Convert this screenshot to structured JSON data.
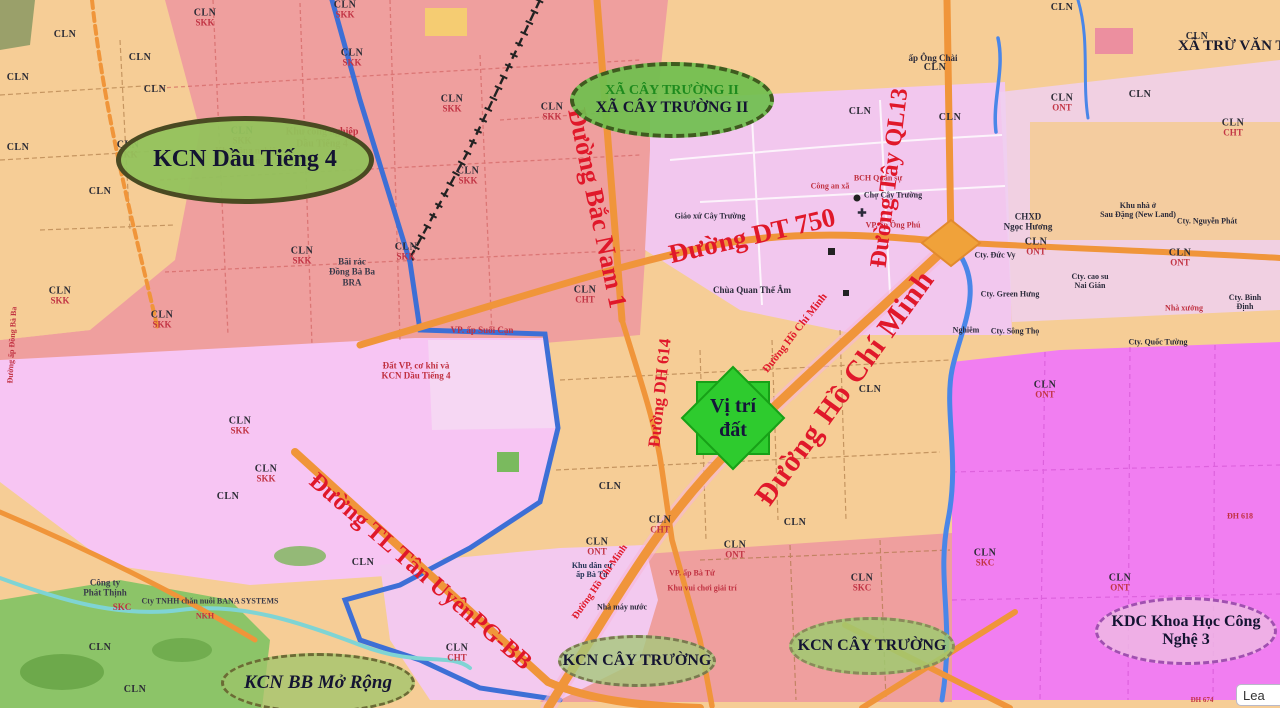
{
  "map": {
    "corner_label": "XÃ TRỪ VĂN THỐ",
    "attribution_partial": "Lea"
  },
  "site_marker": {
    "line1": "Vị trí",
    "line2": "đất"
  },
  "badges": {
    "kcn_dau_tieng_4": {
      "label": "KCN Dầu Tiếng 4"
    },
    "xa_cay_truong_ii": {
      "line1": "XÃ CÂY TRƯỜNG II",
      "line2": "XÃ CÂY TRƯỜNG II"
    },
    "kcn_bb_mo_rong": {
      "label": "KCN BB Mở Rộng"
    },
    "kcn_cay_truong_1": {
      "label": "KCN CÂY TRƯỜNG"
    },
    "kcn_cay_truong_2": {
      "label": "KCN CÂY TRƯỜNG"
    },
    "kdc_khoa_hoc": {
      "line1": "KDC Khoa Học Công",
      "line2": "Nghệ 3"
    }
  },
  "road_labels": {
    "bac_nam_1": "Đường Bắc Nam 1",
    "dt_750": "Đường DT 750",
    "dh_614": "Đường DH 614",
    "ho_chi_minh": "Đường Hồ Chí Minh",
    "ho_chi_minh_small": "Đường Hồ Chí Minh",
    "ho_chi_minh_small2": "Đường Hồ Chí Minh",
    "tay_ql13": "Đường Tây QL13",
    "tl_tan_uyen": "Đường TL Tân UyênPG-BB"
  },
  "poi_labels": [
    {
      "t": "Khu công nghiệp\nDầu Tiếng 4",
      "x": 322,
      "y": 138,
      "c": "#c03040",
      "s": 10
    },
    {
      "t": "Khu công nghiệp\nDầu Tiếng 4",
      "x": 248,
      "y": 156,
      "c": "#c03040",
      "s": 9
    },
    {
      "t": "Bãi rác\nĐồng Bà Ba\nBRA",
      "x": 352,
      "y": 272,
      "c": "#3a3a4a",
      "s": 9
    },
    {
      "t": "Đất VP, cơ khí và\nKCN Dầu Tiếng 4",
      "x": 416,
      "y": 371,
      "c": "#c03040",
      "s": 9
    },
    {
      "t": "VP. ấp Suối Cạn",
      "x": 482,
      "y": 330,
      "c": "#c03040",
      "s": 9
    },
    {
      "t": "Đường ấp Đồng Bà Ba",
      "x": 12,
      "y": 345,
      "c": "#c03040",
      "s": 8,
      "r": -87
    },
    {
      "t": "Công ty\nPhát Thịnh",
      "x": 105,
      "y": 588,
      "c": "#3a3a4a",
      "s": 9
    },
    {
      "t": "Cty TNHH chăn nuôi BANA SYSTEMS",
      "x": 210,
      "y": 601,
      "c": "#3a3a4a",
      "s": 8
    },
    {
      "t": "NKH",
      "x": 205,
      "y": 616,
      "c": "#c03040",
      "s": 8
    },
    {
      "t": "SKC",
      "x": 122,
      "y": 607,
      "c": "#c03040",
      "s": 9
    },
    {
      "t": "ấp Ông Chài",
      "x": 933,
      "y": 58,
      "c": "#2a2a3a",
      "s": 9
    },
    {
      "t": "Công an xã",
      "x": 830,
      "y": 186,
      "c": "#c03040",
      "s": 8
    },
    {
      "t": "BCH Quân sự",
      "x": 878,
      "y": 178,
      "c": "#c03040",
      "s": 8
    },
    {
      "t": "Chợ Cây Trường",
      "x": 893,
      "y": 195,
      "c": "#2a2a3a",
      "s": 8
    },
    {
      "t": "✚",
      "x": 862,
      "y": 214,
      "c": "#2a2a3a",
      "s": 11
    },
    {
      "t": "VP. ấp Ông Phú",
      "x": 893,
      "y": 225,
      "c": "#c03040",
      "s": 8
    },
    {
      "t": "Giáo xứ Cây Trường",
      "x": 710,
      "y": 216,
      "c": "#2a2a3a",
      "s": 8
    },
    {
      "t": "Chùa Quan Thế Âm",
      "x": 752,
      "y": 290,
      "c": "#2a2a3a",
      "s": 9
    },
    {
      "t": "CHXD\nNgọc Hương",
      "x": 1028,
      "y": 222,
      "c": "#2a2a3a",
      "s": 9
    },
    {
      "t": "Cty. Đức Vy",
      "x": 995,
      "y": 255,
      "c": "#2a2a3a",
      "s": 8
    },
    {
      "t": "Khu nhà ở\nSau Đặng (New Land)",
      "x": 1138,
      "y": 210,
      "c": "#2a2a3a",
      "s": 8
    },
    {
      "t": "Cty. Nguyễn Phát",
      "x": 1207,
      "y": 221,
      "c": "#2a2a3a",
      "s": 8
    },
    {
      "t": "Cty. cao su\nNai Gián",
      "x": 1090,
      "y": 281,
      "c": "#2a2a3a",
      "s": 8
    },
    {
      "t": "Cty. Green Hưng",
      "x": 1010,
      "y": 294,
      "c": "#2a2a3a",
      "s": 8
    },
    {
      "t": "Cty. Bình Định",
      "x": 1245,
      "y": 302,
      "c": "#2a2a3a",
      "s": 8
    },
    {
      "t": "Nhà xưởng",
      "x": 1184,
      "y": 308,
      "c": "#c03040",
      "s": 8
    },
    {
      "t": "Cty. Quốc Tường",
      "x": 1158,
      "y": 342,
      "c": "#2a2a3a",
      "s": 8
    },
    {
      "t": "Cty. Sông Thọ",
      "x": 1015,
      "y": 331,
      "c": "#2a2a3a",
      "s": 8
    },
    {
      "t": "Nghiêm",
      "x": 966,
      "y": 330,
      "c": "#2a2a3a",
      "s": 8
    },
    {
      "t": "Khu dân cư\nấp Bà Tứ",
      "x": 592,
      "y": 570,
      "c": "#223355",
      "s": 8
    },
    {
      "t": "VP. ấp Bà Tứ",
      "x": 692,
      "y": 573,
      "c": "#c03040",
      "s": 8
    },
    {
      "t": "Khu vui chơi giải trí",
      "x": 702,
      "y": 588,
      "c": "#c03040",
      "s": 8
    },
    {
      "t": "Nhà máy nước",
      "x": 622,
      "y": 607,
      "c": "#2a2a3a",
      "s": 8
    },
    {
      "t": "ĐH 618",
      "x": 1240,
      "y": 516,
      "c": "#c03040",
      "s": 8
    },
    {
      "t": "ĐH 674",
      "x": 1202,
      "y": 700,
      "c": "#c03040",
      "s": 7
    }
  ],
  "parcel_labels": [
    {
      "code": "CLN",
      "use": "SKK",
      "x": 205,
      "y": 18
    },
    {
      "code": "CLN",
      "use": "SKK",
      "x": 345,
      "y": 10
    },
    {
      "code": "CLN",
      "use": "SKK",
      "x": 452,
      "y": 104
    },
    {
      "code": "CLN",
      "use": "SKK",
      "x": 128,
      "y": 150
    },
    {
      "code": "CLN",
      "use": "SKK",
      "x": 242,
      "y": 136
    },
    {
      "code": "CLN",
      "use": "SKK",
      "x": 302,
      "y": 256
    },
    {
      "code": "CLN",
      "use": "SKK",
      "x": 406,
      "y": 252
    },
    {
      "code": "CLN",
      "use": "SKK",
      "x": 162,
      "y": 320
    },
    {
      "code": "CLN",
      "use": "SKK",
      "x": 60,
      "y": 296
    },
    {
      "code": "CLN",
      "use": "SKK",
      "x": 240,
      "y": 426
    },
    {
      "code": "CLN",
      "use": "SKK",
      "x": 266,
      "y": 474
    },
    {
      "code": "CLN",
      "use": "SKK",
      "x": 552,
      "y": 112
    },
    {
      "code": "CLN",
      "use": "SKK",
      "x": 468,
      "y": 176
    },
    {
      "code": "CLN",
      "use": "SKK",
      "x": 352,
      "y": 58
    },
    {
      "code": "CLN",
      "use": "",
      "x": 65,
      "y": 35
    },
    {
      "code": "CLN",
      "use": "",
      "x": 140,
      "y": 58
    },
    {
      "code": "CLN",
      "use": "",
      "x": 18,
      "y": 78
    },
    {
      "code": "CLN",
      "use": "",
      "x": 100,
      "y": 192
    },
    {
      "code": "CLN",
      "use": "",
      "x": 18,
      "y": 148
    },
    {
      "code": "CLN",
      "use": "",
      "x": 155,
      "y": 90
    },
    {
      "code": "CLN",
      "use": "",
      "x": 935,
      "y": 68
    },
    {
      "code": "CLN",
      "use": "",
      "x": 1140,
      "y": 95
    },
    {
      "code": "CLN",
      "use": "",
      "x": 1197,
      "y": 37
    },
    {
      "code": "CLN",
      "use": "",
      "x": 1062,
      "y": 8
    },
    {
      "code": "CLN",
      "use": "",
      "x": 860,
      "y": 112
    },
    {
      "code": "CLN",
      "use": "",
      "x": 950,
      "y": 118
    },
    {
      "code": "CLN",
      "use": "",
      "x": 870,
      "y": 390
    },
    {
      "code": "CLN",
      "use": "",
      "x": 795,
      "y": 523
    },
    {
      "code": "CLN",
      "use": "",
      "x": 610,
      "y": 487
    },
    {
      "code": "CLN",
      "use": "",
      "x": 363,
      "y": 563
    },
    {
      "code": "CLN",
      "use": "",
      "x": 228,
      "y": 497
    },
    {
      "code": "CLN",
      "use": "",
      "x": 100,
      "y": 648
    },
    {
      "code": "CLN",
      "use": "",
      "x": 135,
      "y": 690
    },
    {
      "code": "CLN",
      "use": "ONT",
      "x": 1062,
      "y": 103
    },
    {
      "code": "CLN",
      "use": "ONT",
      "x": 1180,
      "y": 258
    },
    {
      "code": "CLN",
      "use": "ONT",
      "x": 1036,
      "y": 247
    },
    {
      "code": "CLN",
      "use": "ONT",
      "x": 1045,
      "y": 390
    },
    {
      "code": "CLN",
      "use": "ONT",
      "x": 1120,
      "y": 583
    },
    {
      "code": "CLN",
      "use": "ONT",
      "x": 597,
      "y": 547
    },
    {
      "code": "CLN",
      "use": "ONT",
      "x": 735,
      "y": 550
    },
    {
      "code": "CLN",
      "use": "CHT",
      "x": 585,
      "y": 295
    },
    {
      "code": "CLN",
      "use": "CHT",
      "x": 1233,
      "y": 128
    },
    {
      "code": "CLN",
      "use": "CHT",
      "x": 457,
      "y": 653
    },
    {
      "code": "CLN",
      "use": "CHT",
      "x": 660,
      "y": 525
    },
    {
      "code": "CLN",
      "use": "SKC",
      "x": 862,
      "y": 583
    },
    {
      "code": "CLN",
      "use": "SKC",
      "x": 985,
      "y": 558
    }
  ]
}
